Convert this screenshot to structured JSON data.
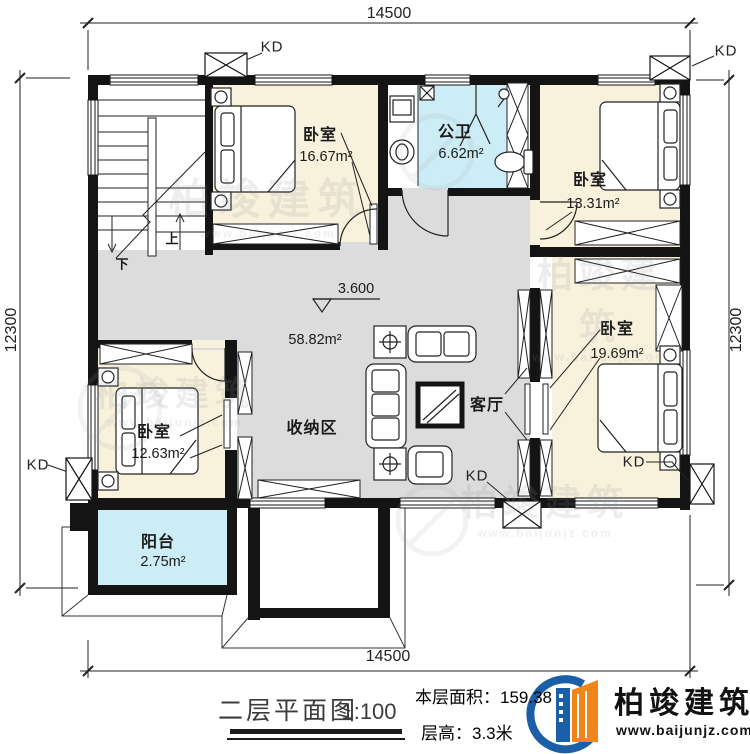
{
  "dimensions": {
    "top": "14500",
    "bottom": "14500",
    "left": "12300",
    "right": "12300"
  },
  "labels": {
    "kd": "KD",
    "up": "上",
    "down": "下",
    "elevation": "3.600",
    "hall_area": "58.82m²"
  },
  "rooms": {
    "bedroom_top_left": {
      "name": "卧室",
      "area": "16.67m²"
    },
    "bathroom": {
      "name": "公卫",
      "area": "6.62m²"
    },
    "bedroom_top_right": {
      "name": "卧室",
      "area": "13.31m²"
    },
    "bedroom_right": {
      "name": "卧室",
      "area": "19.69m²"
    },
    "bedroom_bottom_left": {
      "name": "卧室",
      "area": "12.63m²"
    },
    "living_room": {
      "name": "客厅"
    },
    "storage": {
      "name": "收纳区"
    },
    "balcony": {
      "name": "阳台",
      "area": "2.75m²"
    }
  },
  "titleblock": {
    "title": "二层平面图",
    "scale": "1:100",
    "floor_area": "本层面积：159.38",
    "floor_height": "层高：3.3米"
  },
  "branding": {
    "name": "柏竣建筑",
    "website": "www.baijunjz.com"
  },
  "watermark": {
    "name": "柏竣建筑",
    "website": "www.baijunjz.com"
  },
  "colors": {
    "bedroom_fill": "#F8F1DC",
    "wet_fill": "#CDEDF6",
    "hall_fill": "#DCDCDC",
    "wall": "#141414",
    "brand_blue": "#1B5FA8",
    "brand_orange": "#F08519"
  }
}
